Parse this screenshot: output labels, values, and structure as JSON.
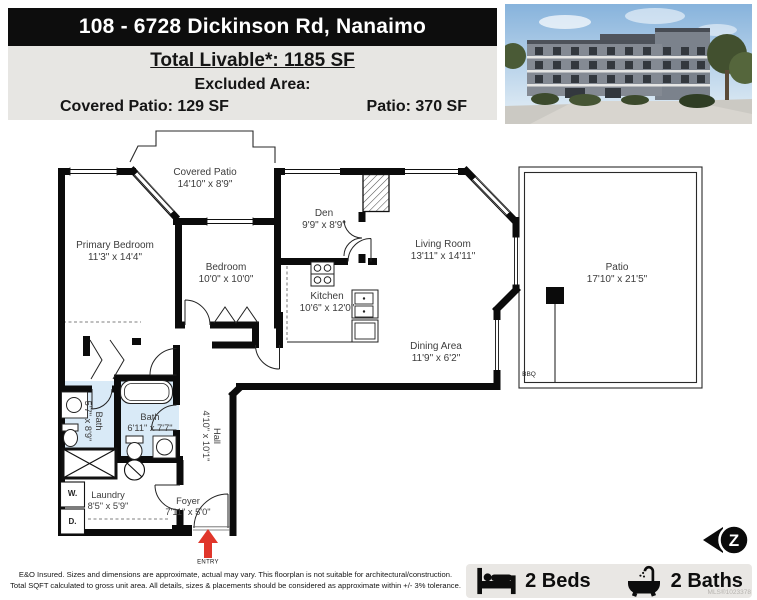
{
  "header": {
    "address": "108 - 6728 Dickinson Rd, Nanaimo",
    "total_livable": "Total Livable*: 1185 SF",
    "excluded_label": "Excluded Area:",
    "covered_patio_sf": "Covered Patio: 129 SF",
    "patio_sf": "Patio: 370 SF"
  },
  "rooms": {
    "covered_patio": {
      "name": "Covered Patio",
      "dims": "14'10\" x 8'9\""
    },
    "primary_bedroom": {
      "name": "Primary Bedroom",
      "dims": "11'3\" x 14'4\""
    },
    "bedroom": {
      "name": "Bedroom",
      "dims": "10'0\" x 10'0\""
    },
    "den": {
      "name": "Den",
      "dims": "9'9\" x 8'9\""
    },
    "living_room": {
      "name": "Living Room",
      "dims": "13'11\" x 14'11\""
    },
    "kitchen": {
      "name": "Kitchen",
      "dims": "10'6\" x 12'0\""
    },
    "dining_area": {
      "name": "Dining Area",
      "dims": "11'9\" x 6'2\""
    },
    "patio": {
      "name": "Patio",
      "dims": "17'10\" x 21'5\""
    },
    "bath_ensuite": {
      "name": "Bath",
      "dims": "5'7\" x 8'9\""
    },
    "bath_main": {
      "name": "Bath",
      "dims": "6'11\" x 7'7\""
    },
    "hall": {
      "name": "Hall",
      "dims": "4'10\" x 10'1\""
    },
    "laundry": {
      "name": "Laundry",
      "dims": "8'5\" x 5'9\""
    },
    "foyer": {
      "name": "Foyer",
      "dims": "7'11\" x 5'0\""
    }
  },
  "plan_labels": {
    "bbq": "BBQ",
    "entry": "ENTRY",
    "washer": "W.",
    "dryer": "D."
  },
  "footer": {
    "disclaimer_line1": "E&O Insured. Sizes and dimensions are approximate, actual may vary. This floorplan is not suitable for architectural/construction.",
    "disclaimer_line2": "Total SQFT calculated to gross unit area. All details, sizes & placements should be considered as approximate within +/- 3% tolerance.",
    "beds": "2 Beds",
    "baths": "2 Baths",
    "mls": "MLS®1023378",
    "logo_letter": "Z"
  },
  "colors": {
    "header_bg": "#0d0d0d",
    "panel_bg": "#e7e6e3",
    "bath_fill": "#d9eaf7",
    "entry_arrow": "#e0362b"
  }
}
